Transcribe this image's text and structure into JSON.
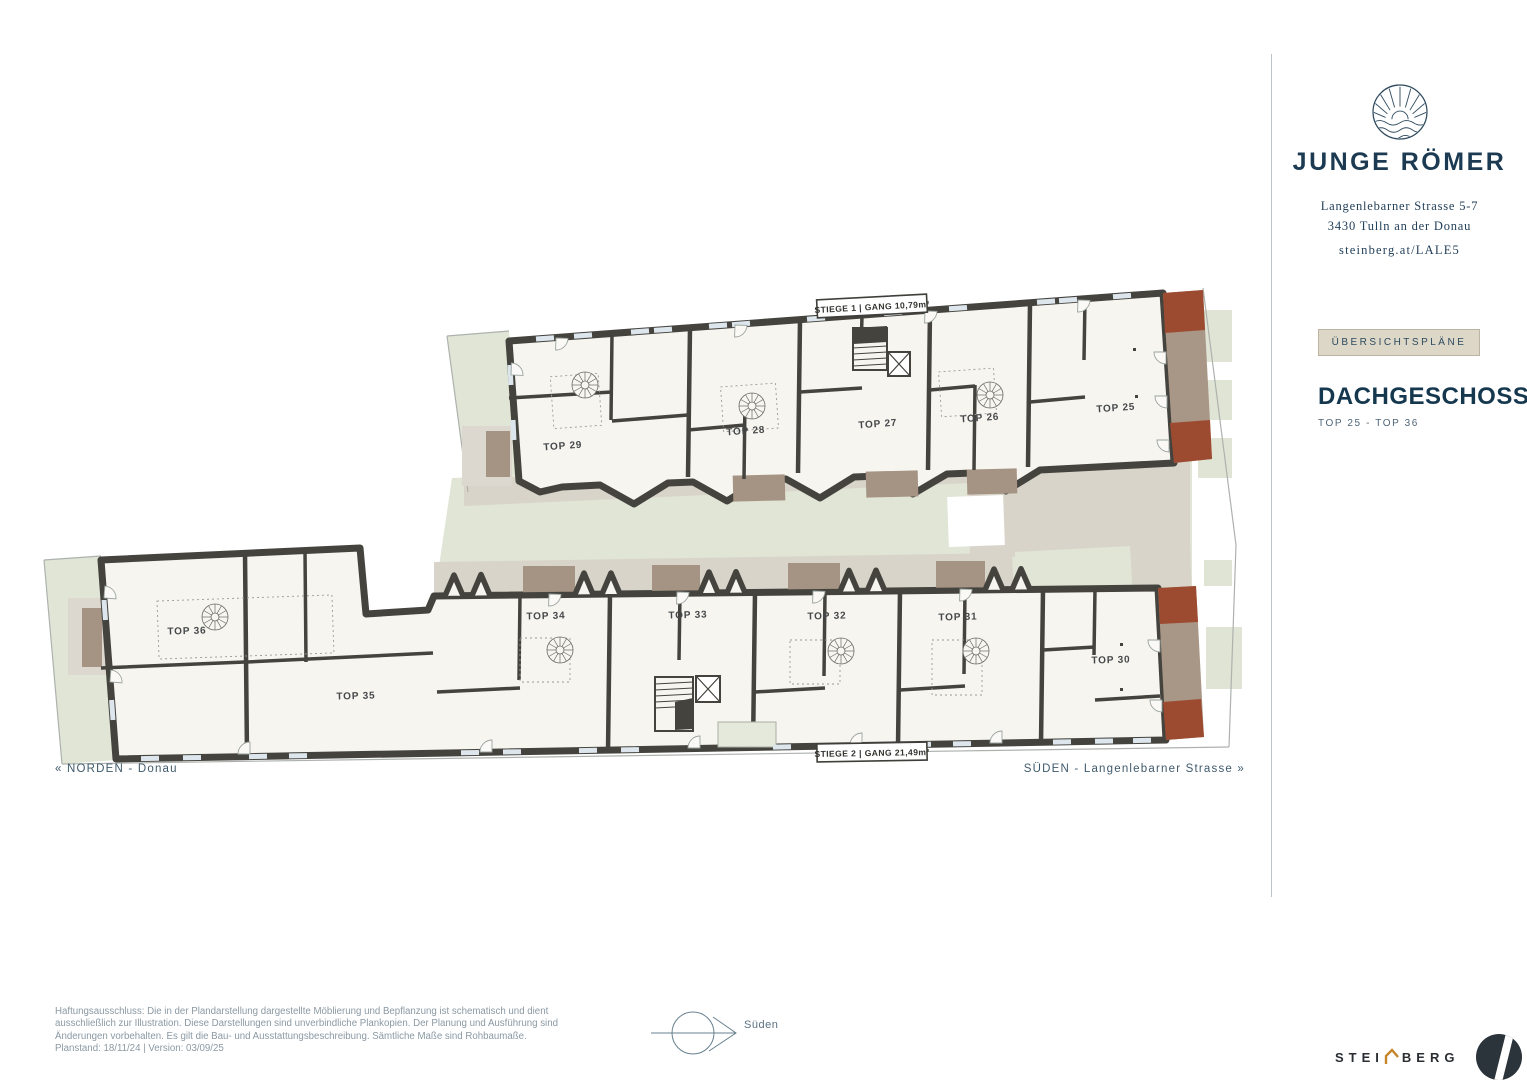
{
  "brand": {
    "name": "JUNGE RÖMER",
    "address_line1": "Langenlebarner Strasse 5-7",
    "address_line2": "3430 Tulln an der Donau",
    "website": "steinberg.at/LALE5"
  },
  "sidebar": {
    "overview_button": "ÜBERSICHTSPLÄNE",
    "floor_title": "DACHGESCHOSS",
    "floor_subtitle": "TOP 25 - TOP 36"
  },
  "plan": {
    "stiege1_label": "STIEGE 1   |   GANG  10,79m²",
    "stiege2_label": "STIEGE 2   |   GANG  21,49m²",
    "north_label": "« NORDEN - Donau",
    "south_label": "SÜDEN - Langenlebarner Strasse »",
    "units": [
      {
        "label": "TOP 25"
      },
      {
        "label": "TOP 26"
      },
      {
        "label": "TOP 27"
      },
      {
        "label": "TOP 28"
      },
      {
        "label": "TOP 29"
      },
      {
        "label": "TOP 30"
      },
      {
        "label": "TOP 31"
      },
      {
        "label": "TOP 32"
      },
      {
        "label": "TOP 33"
      },
      {
        "label": "TOP 34"
      },
      {
        "label": "TOP 35"
      },
      {
        "label": "TOP 36"
      }
    ]
  },
  "compass": {
    "label": "Süden"
  },
  "footer": {
    "disclaimer": "Haftungsausschluss: Die in der Plandarstellung dargestellte Möblierung und Bepflanzung ist schematisch und dient ausschließlich zur Illustration. Diese Darstellungen sind unverbindliche Plankopien. Der Planung und Ausführung sind Änderungen vorbehalten. Es gilt die Bau- und Ausstattungsbeschreibung. Sämtliche Maße sind Rohbaumaße. Planstand: 18/11/24  |  Version: 03/09/25",
    "logo_left": "STEI",
    "logo_right": "BERG"
  },
  "colors": {
    "navy": "#1c3b52",
    "wall": "#44433e",
    "room": "#f7f5f0",
    "courtyard_green": "#e0e5d6",
    "path_gray": "#d9d4ca",
    "balcony_brown": "#a59483",
    "terracotta": "#9d4b30",
    "button_beige": "#ddd7c8",
    "accent_orange": "#c5862b"
  }
}
